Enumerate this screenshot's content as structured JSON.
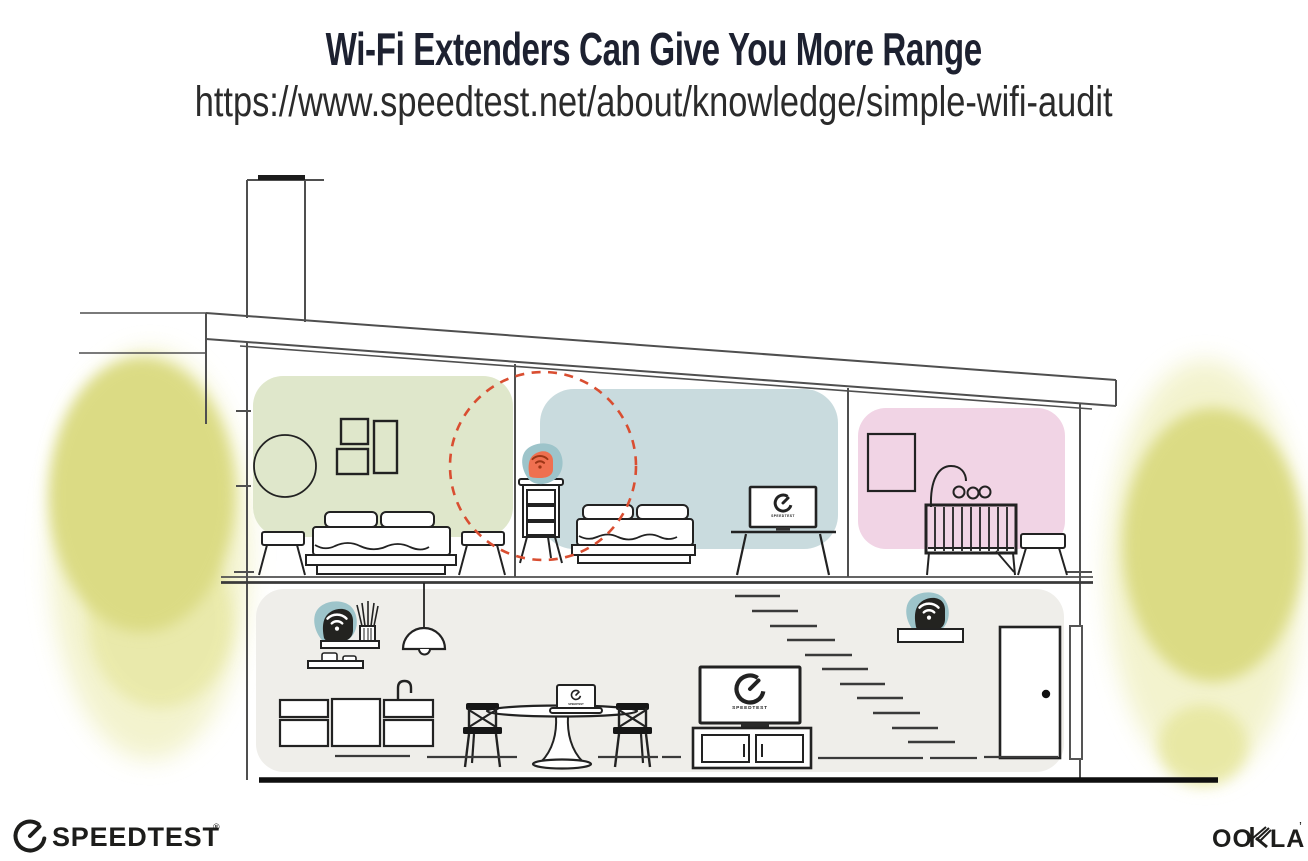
{
  "header": {
    "title": "Wi-Fi Extenders Can Give You More Range",
    "url": "https://www.speedtest.net/about/knowledge/simple-wifi-audit"
  },
  "footer": {
    "speedtest_label": "SPEEDTEST",
    "speedtest_mark": "®",
    "ookla_label_left": "OO",
    "ookla_label_right": "LA",
    "ookla_mark": "’"
  },
  "illustration": {
    "colors": {
      "room_green": "#dfe7cb",
      "room_blue": "#c9dbde",
      "room_pink": "#f1d4e5",
      "floor_gray": "#efeeea",
      "tree_yellow": "#dbdb84",
      "extender_orange": "#ef7050",
      "device_black": "#232320",
      "teal_halo": "#9dc4ca",
      "highlight_red": "#d94e31"
    },
    "rooms": [
      {
        "name": "bedroom-left",
        "color_key": "room_green"
      },
      {
        "name": "bedroom-center",
        "color_key": "room_blue"
      },
      {
        "name": "nursery",
        "color_key": "room_pink"
      },
      {
        "name": "living-kitchen-area",
        "color_key": "floor_gray"
      }
    ],
    "devices": [
      {
        "name": "wifi-extender-highlighted",
        "location": "dresser in center bedroom",
        "color_key": "extender_orange",
        "highlighted": true
      },
      {
        "name": "wifi-router",
        "location": "kitchen shelf",
        "color_key": "device_black",
        "highlighted": false
      },
      {
        "name": "wifi-extender",
        "location": "shelf by stairs",
        "color_key": "device_black",
        "highlighted": false
      }
    ],
    "screens": [
      {
        "name": "bedroom-tv",
        "label": "SPEEDTEST"
      },
      {
        "name": "living-tv",
        "label": "SPEEDTEST"
      },
      {
        "name": "laptop",
        "label": "SPEEDTEST"
      }
    ]
  }
}
